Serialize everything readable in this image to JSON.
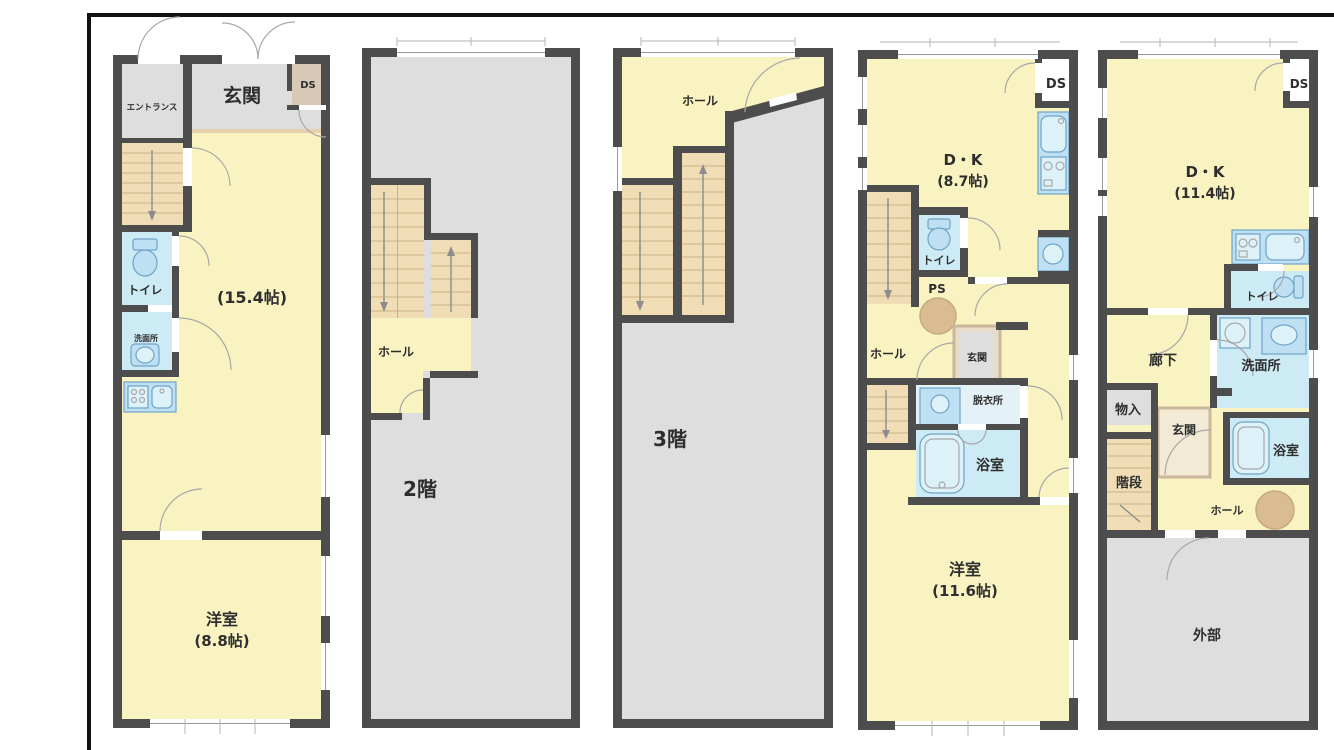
{
  "document": {
    "type": "floor-plan-set",
    "panel_count": 5
  },
  "floors": {
    "f1": {
      "entrance": "エントランス",
      "genkan": "玄関",
      "ds": "DS",
      "toilet": "トイレ",
      "washroom": "洗面所",
      "living_size": "(15.4帖)",
      "bedroom": "洋室",
      "bedroom_size": "(8.8帖)"
    },
    "f2": {
      "hall": "ホール",
      "floor_label": "2階"
    },
    "f3": {
      "hall": "ホール",
      "floor_label": "3階"
    },
    "f4": {
      "dk": "D・K",
      "dk_size": "(8.7帖)",
      "ds": "DS",
      "toilet": "トイレ",
      "ps": "PS",
      "hall": "ホール",
      "genkan": "玄関",
      "dressing_room": "脱衣所",
      "bathroom": "浴室",
      "bedroom": "洋室",
      "bedroom_size": "(11.6帖)"
    },
    "f5": {
      "dk": "D・K",
      "dk_size": "(11.4帖)",
      "ds": "DS",
      "toilet": "トイレ",
      "corridor": "廊下",
      "washroom": "洗面所",
      "storage": "物入",
      "genkan": "玄関",
      "bathroom": "浴室",
      "stairs": "階段",
      "hall": "ホール",
      "exterior": "外部"
    }
  },
  "colors": {
    "wall": "#4d4d4d",
    "room_yellow": "#f8f3c1",
    "common_gray": "#dedede",
    "stair_tan": "#f1ddb5",
    "water_blue": "#cdebf5",
    "fixture_blue": "#bfe0f2",
    "storage_tan": "#d8c8b6",
    "column_circle": "#d9bc90",
    "frame": "#111111"
  }
}
